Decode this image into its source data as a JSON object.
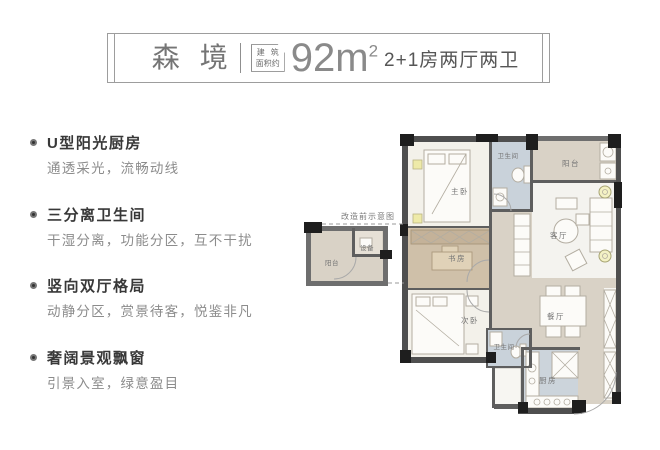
{
  "header": {
    "title": "森境",
    "area_label_line1": "建筑",
    "area_label_line2": "面积约",
    "area_value": "92m",
    "area_superscript": "2",
    "layout_spec": "2+1房两厅两卫"
  },
  "features": [
    {
      "title": "U型阳光厨房",
      "desc": "通透采光，流畅动线"
    },
    {
      "title": "三分离卫生间",
      "desc": "干湿分离，功能分区，互不干扰"
    },
    {
      "title": "竖向双厅格局",
      "desc": "动静分区，赏景待客，悦鉴非凡"
    },
    {
      "title": "奢阔景观飘窗",
      "desc": "引景入室，绿意盈目"
    }
  ],
  "floorplan": {
    "note_label": "改造前示意图",
    "labels": {
      "master_bedroom": "主卧",
      "bathroom_top": "卫生间",
      "balcony_top": "阳台",
      "living_room": "客厅",
      "study": "书房",
      "second_bedroom": "次卧",
      "dining_room": "餐厅",
      "bathroom_bottom": "卫生间",
      "kitchen": "厨房",
      "balcony_small": "阳台",
      "equipment": "设备"
    },
    "colors": {
      "wall": "#4f4f4f",
      "wall_black": "#1e1e1e",
      "floor_beige": "#d9d2c6",
      "floor_light": "#f3f1ea",
      "floor_blue": "#c9d2da",
      "floor_tan": "#cfc0a9",
      "floor_kitchen": "#ccd4db",
      "marker_yellow": "#eeeaa8"
    }
  }
}
